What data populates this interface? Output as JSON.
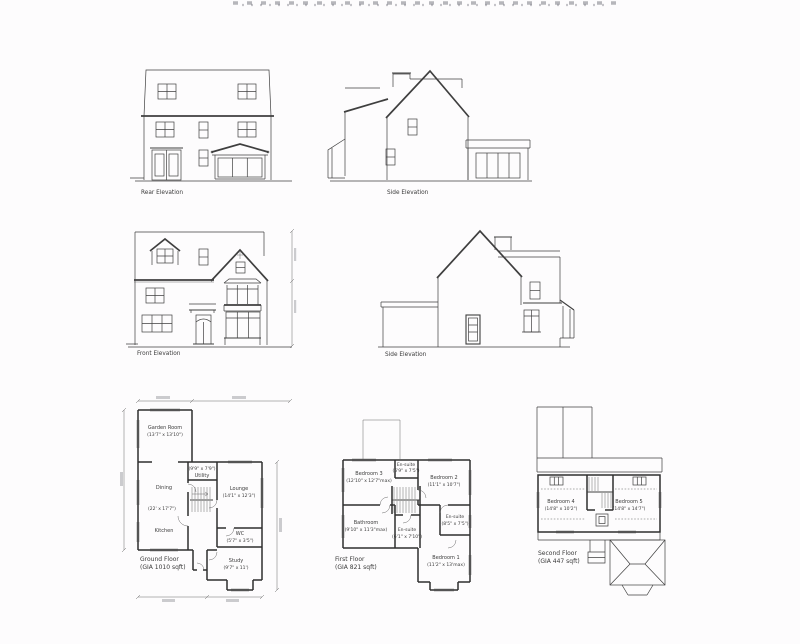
{
  "sheet": {
    "background": "#fdfcfd",
    "ink": "#3f3f3f"
  },
  "elevations": {
    "rear": {
      "label": "Rear Elevation"
    },
    "side_upper": {
      "label": "Side Elevation"
    },
    "front": {
      "label": "Front Elevation"
    },
    "side_lower": {
      "label": "Side Elevation"
    }
  },
  "floor_plans": {
    "ground": {
      "label": "Ground Floor",
      "area": "(GIA 1010 sqft)",
      "rooms": {
        "garden_room": {
          "name": "Garden Room",
          "dims": "(13'7\" x 13'10\")"
        },
        "dining": {
          "name": "Dining",
          "dims": "(22' x 17'7\")"
        },
        "kitchen": {
          "name": "Kitchen"
        },
        "utility": {
          "name": "Utility",
          "dims": "(9'9\" x 7'9\")"
        },
        "lounge": {
          "name": "Lounge",
          "dims": "(14'1\" x 12'3\")"
        },
        "wc": {
          "name": "WC",
          "dims": "(5'7\" x 3'5\")"
        },
        "study": {
          "name": "Study",
          "dims": "(9'7\" x 11')"
        }
      }
    },
    "first": {
      "label": "First Floor",
      "area": "(GIA 821 sqft)",
      "rooms": {
        "bedroom3": {
          "name": "Bedroom 3",
          "dims": "(12'10\" x 12'7\"max)"
        },
        "ensuite_top": {
          "name": "En-suite",
          "dims": "(6'9\" x 7'5\")"
        },
        "bedroom2": {
          "name": "Bedroom 2",
          "dims": "(11'1\" x 10'7\")"
        },
        "bathroom": {
          "name": "Bathroom",
          "dims": "(9'10\" x 11'3\"max)"
        },
        "ensuite_mid": {
          "name": "En-suite",
          "dims": "(6'1\" x 7'10\")"
        },
        "ensuite_right": {
          "name": "En-suite",
          "dims": "(8'5\" x 7'5\")"
        },
        "bedroom1": {
          "name": "Bedroom 1",
          "dims": "(11'2\" x 13'max)"
        }
      }
    },
    "second": {
      "label": "Second Floor",
      "area": "(GIA 447 sqft)",
      "rooms": {
        "bedroom4": {
          "name": "Bedroom 4",
          "dims": "(14'8\" x 10'2\")"
        },
        "bedroom5": {
          "name": "Bedroom 5",
          "dims": "(14'8\" x 14'7\")"
        }
      }
    }
  }
}
